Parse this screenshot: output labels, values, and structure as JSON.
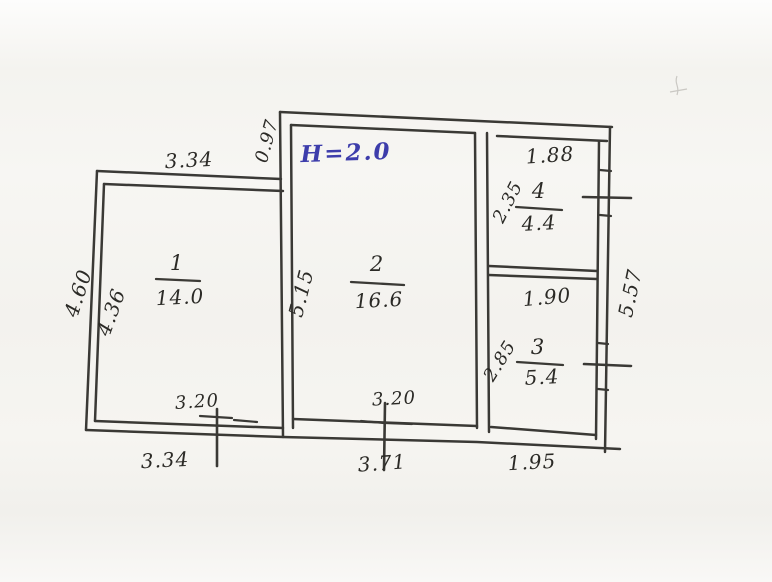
{
  "floorplan": {
    "height_note": "H=2.0",
    "rooms": [
      {
        "number": "1",
        "area": "14.0"
      },
      {
        "number": "2",
        "area": "16.6"
      },
      {
        "number": "3",
        "area": "5.4"
      },
      {
        "number": "4",
        "area": "4.4"
      }
    ],
    "dims": {
      "room1_top": "3.34",
      "room1_left_outer": "4.60",
      "room1_left_inner": "4.36",
      "room1_bottom_wall": "3.20",
      "room1_bottom_total": "3.34",
      "room2_top_offset": "0.97",
      "room2_left": "5.15",
      "room2_bottom_wall": "3.20",
      "room2_bottom_total": "3.71",
      "room4_top": "1.88",
      "room4_left": "2.35",
      "room3_top": "1.90",
      "room3_left": "2.85",
      "room3_bottom_total": "1.95",
      "right_side_total": "5.57"
    },
    "colors": {
      "ink": "#2b2a26",
      "blue_ink": "#3d3dab",
      "paper": "#f6f5f1"
    }
  }
}
